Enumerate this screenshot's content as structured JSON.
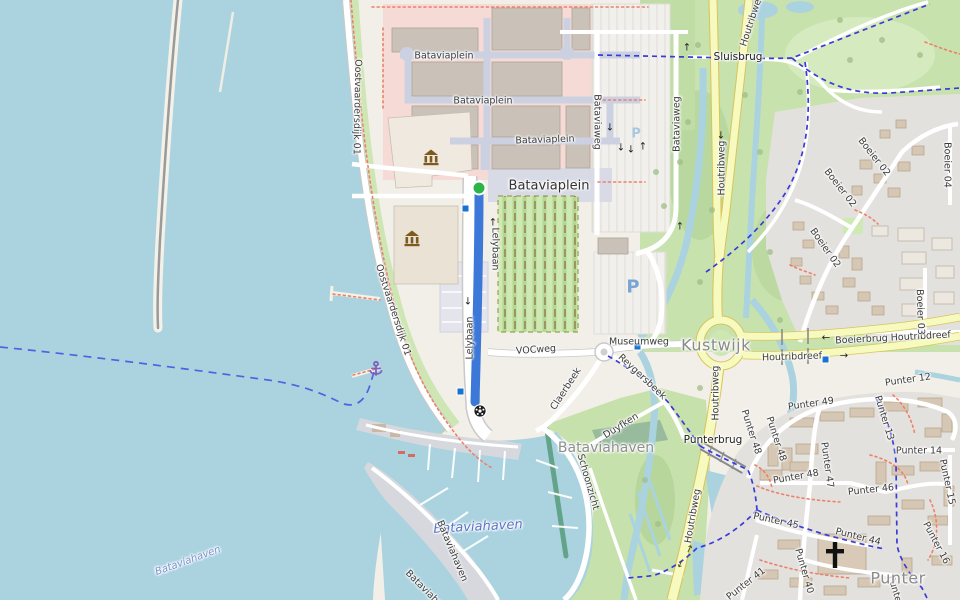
{
  "map": {
    "kind": "street-map-with-highlighted-route",
    "labels": {
      "bataviaplein": "Bataviaplein",
      "oostvaardersdijk_01": "Oostvaardersdijk 01",
      "lelybaan": "Lelybaan",
      "vocweg": "VOCweg",
      "museumweg": "Museumweg",
      "kustwijk": "Kustwijk",
      "houtribweg": "Houtribweg",
      "houtribdreef": "Houtribdreef",
      "boeierbrug_houtribdreef": "Boeierbrug Houtribdreef",
      "sluisbrug": "Sluisbrug",
      "punterbrug": "Punterbrug",
      "bataviaweg": "Bataviaweg",
      "bataviahaven": "Bataviahaven",
      "boeier_02": "Boeier 02",
      "boeier_03": "Boeier 03",
      "boeier_04": "Boeier 04",
      "punter": "Punter",
      "punter_12": "Punter 12",
      "punter_13": "Punter 13",
      "punter_14": "Punter 14",
      "punter_15": "Punter 15",
      "punter_16": "Punter 16",
      "punter_23": "Punter 23",
      "punter_40": "Punter 40",
      "punter_41": "Punter 41",
      "punter_44": "Punter 44",
      "punter_45": "Punter 45",
      "punter_46": "Punter 46",
      "punter_47": "Punter 47",
      "punter_48": "Punter 48",
      "punter_49": "Punter 49",
      "reygersbeek": "Reygersbeek",
      "claerbeek": "Claerbeek",
      "duyfken": "Duyfken",
      "schoonzicht": "Schoonzicht",
      "parking": "P"
    },
    "glyphs": {
      "arrow_up": "↑",
      "arrow_down": "↓",
      "arrow_left": "←",
      "arrow_right": "→",
      "anchor": "⚓"
    },
    "colors": {
      "water": "#aad3df",
      "land": "#f2efe9",
      "grass": "#cdebb0",
      "park": "#c8e2ae",
      "residential": "#e3e1de",
      "retail": "#f5dad5",
      "building": "#cac2b8",
      "pedestrian": "#ccd1e2",
      "road_secondary": "#f7fabe",
      "route_highlight": "#3c78d8",
      "route_start": "#2eb34a",
      "cycle_route": "#3b3bd8",
      "foot_path": "#ed8068",
      "bus_stop": "#1673d2",
      "water_label": "#5b74c4",
      "marina_anchor": "#7c62c0",
      "museum_icon": "#7d5a1e"
    }
  }
}
